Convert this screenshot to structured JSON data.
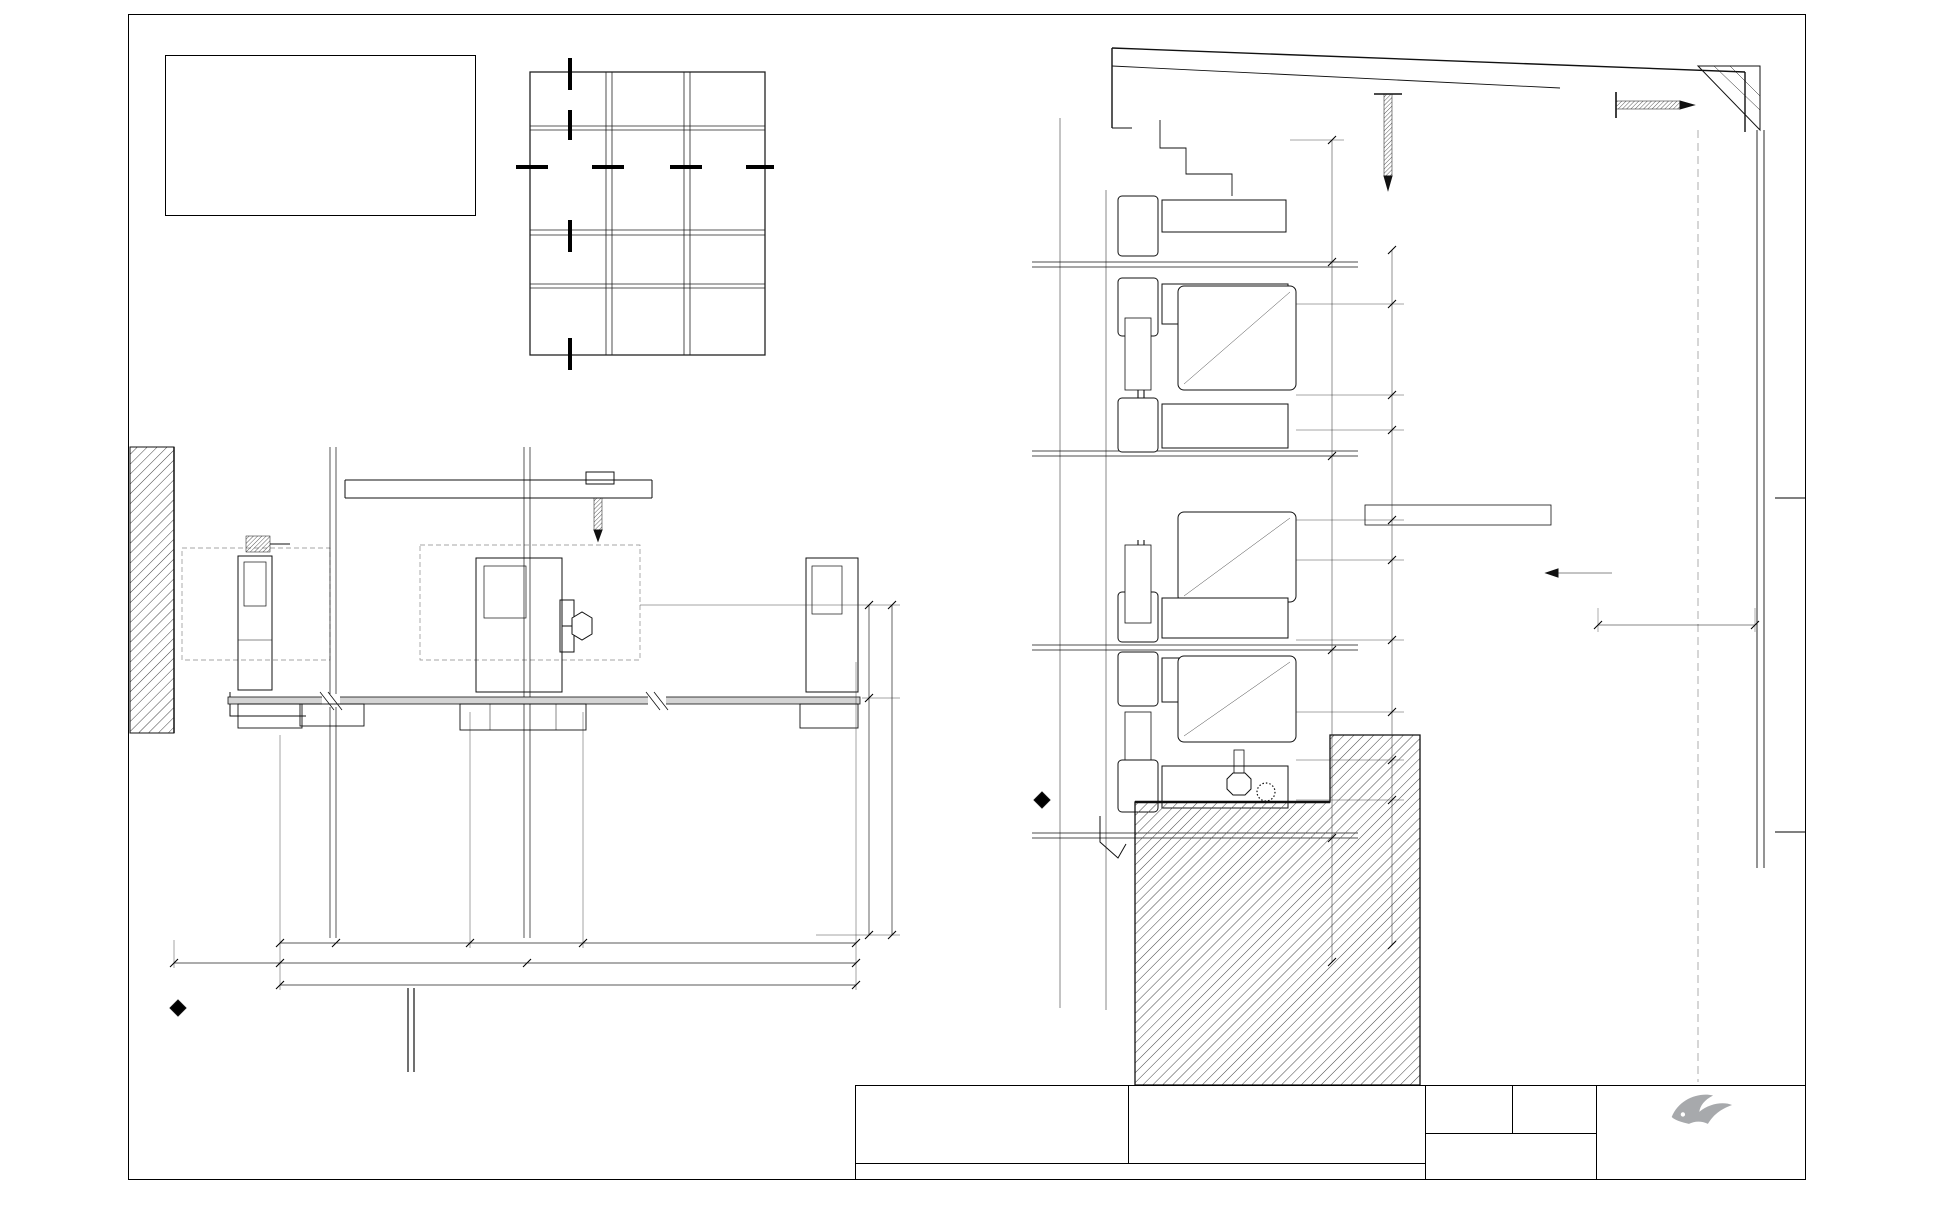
{
  "notes": {
    "title": "NOTES:",
    "lines": [
      "1] DRAWING TO BE USED IN CONJUNCTION WITH 'MASTERSPEC' (4211)",
      "2] WINDOW SYSTEMS REQUIRE SPECIFIC DESIGN DEPENDING ON SPANS,",
      "WIND-LOADS, BUILDING CONDITIONS, ETC.",
      "3] INSIDE GLAZE, INTERNAL REINFORCEMENT AND SEISMIC FRAME",
      "OPTIONS AVAILABLE"
    ],
    "specs": [
      {
        "label": "GLAZING:",
        "value": "GLASS THICKNESS TO SUIT REQUIREMENTS"
      },
      {
        "label": "HARDWARE:",
        "value": "STANDARD HARDWARE OPTIONS"
      },
      {
        "label": "FINISHES:",
        "value": "POWDER-COAT / ANODISED / PVF²"
      }
    ]
  },
  "elevation_callouts": [
    {
      "top": "04",
      "bottom": "01",
      "x": 570,
      "y": 44
    },
    {
      "top": "05",
      "bottom": "01",
      "x": 504,
      "y": 168
    },
    {
      "top": "02",
      "bottom": "01",
      "x": 572,
      "y": 151
    },
    {
      "top": "03",
      "bottom": "01",
      "x": 572,
      "y": 182
    },
    {
      "top": "06",
      "bottom": "01",
      "x": 640,
      "y": 167
    },
    {
      "top": "06",
      "bottom": "01",
      "x": 714,
      "y": 167
    },
    {
      "top": "02",
      "bottom": "01",
      "x": 572,
      "y": 289
    },
    {
      "top": "01",
      "bottom": "01",
      "x": 572,
      "y": 318
    }
  ],
  "detail_callouts": [
    {
      "num": "05",
      "sheet": "01",
      "lines": [
        "JAMB",
        "MULLION"
      ],
      "scale": "1 : 2",
      "x": 280,
      "y": 1032,
      "rx": 418
    },
    {
      "num": "06",
      "sheet": "01",
      "lines": [
        "MULLION"
      ],
      "scale": "1 : 2",
      "x": 550,
      "y": 1032,
      "rx": 645
    },
    {
      "num": "04",
      "sheet": "01",
      "lines": [
        "PARAPET",
        "CAPPING"
      ],
      "scale": "1 : 2",
      "x": 1218,
      "y": 241,
      "rx": 1336
    },
    {
      "num": "03",
      "sheet": "01",
      "lines": [
        "SPLIT TRANSOM"
      ],
      "scale": "1 : 2",
      "x": 1212,
      "y": 460,
      "rx": 1350
    },
    {
      "num": "02",
      "sheet": "01",
      "lines": [
        "TRANSOM"
      ],
      "scale": "1 : 2",
      "x": 1212,
      "y": 712,
      "rx": 1332
    },
    {
      "num": "01",
      "sheet": "01",
      "lines": [
        "SILL TRAY"
      ],
      "scale": "1 : 2",
      "x": 1212,
      "y": 882,
      "rx": 1344
    }
  ],
  "dim_labels": [
    {
      "t": "35",
      "x": 308,
      "y": 936
    },
    {
      "t": "DAYLIGHT",
      "x": 404,
      "y": 936
    },
    {
      "t": "66",
      "x": 531,
      "y": 936
    },
    {
      "t": "DAYLIGHT",
      "x": 722,
      "y": 936
    },
    {
      "t": "33",
      "x": 252,
      "y": 956
    },
    {
      "t": "MULLION SETOUT",
      "x": 410,
      "y": 956
    },
    {
      "t": "MULLION SETOUT",
      "x": 690,
      "y": 956
    },
    {
      "t": "O/A OPENING",
      "x": 566,
      "y": 978
    },
    {
      "t": "50 NOM",
      "x": 862,
      "y": 650,
      "r": -90
    },
    {
      "t": "100 MULLION",
      "x": 862,
      "y": 815,
      "r": -90
    },
    {
      "t": "150 CURTAINWALL ZONE",
      "x": 888,
      "y": 770,
      "r": -90
    },
    {
      "t": "45",
      "x": 1366,
      "y": 200,
      "r": -90
    },
    {
      "t": "86",
      "x": 1328,
      "y": 240,
      "r": -90
    },
    {
      "t": "30",
      "x": 1390,
      "y": 277,
      "r": -90
    },
    {
      "t": "40",
      "x": 1356,
      "y": 290,
      "r": -90
    },
    {
      "t": "DAYLIGHT",
      "x": 1394,
      "y": 344,
      "r": -90
    },
    {
      "t": "O/A MULLION",
      "x": 1334,
      "y": 393,
      "r": -90
    },
    {
      "t": "45",
      "x": 1390,
      "y": 394,
      "r": -90
    },
    {
      "t": "25",
      "x": 1332,
      "y": 463,
      "r": -90
    },
    {
      "t": "30",
      "x": 1390,
      "y": 520,
      "r": -90
    },
    {
      "t": "DAYLIGHT",
      "x": 1352,
      "y": 583,
      "r": -90
    },
    {
      "t": "O/A OPENING",
      "x": 1314,
      "y": 703,
      "r": -90
    },
    {
      "t": "O/A MULLION",
      "x": 1334,
      "y": 703,
      "r": -90
    },
    {
      "t": "66",
      "x": 1356,
      "y": 713,
      "r": -90
    },
    {
      "t": "DAYLIGHT",
      "x": 1356,
      "y": 797,
      "r": -90
    },
    {
      "t": "45",
      "x": 1360,
      "y": 870,
      "r": -90
    },
    {
      "t": "40",
      "x": 1336,
      "y": 948,
      "r": -90
    },
    {
      "t": "50",
      "x": 1676,
      "y": 617
    }
  ],
  "annotations": {
    "backpan_line1": "OPTIONAL BACKPAN WITH INSULATION",
    "backpan_line2": "OPTIONAL FIRE/SMOKE SEALS"
  },
  "brand_label": {
    "name": "Thermosash",
    "product": "PW40",
    "color": "#1668b5",
    "bird_color": "#a7a9ac"
  },
  "brand_positions": [
    {
      "x": 445,
      "y": 556
    },
    {
      "x": 234,
      "y": 676
    },
    {
      "x": 546,
      "y": 688
    },
    {
      "x": 1214,
      "y": 212
    },
    {
      "x": 1243,
      "y": 293
    },
    {
      "x": 1222,
      "y": 521
    },
    {
      "x": 1246,
      "y": 664
    }
  ],
  "title_block": {
    "system_label": "SYSTEM :",
    "system_name": "PW40",
    "system_desc": "UNITISED LOWRISE PANEL SYSTEMS",
    "type_label": "TYPE :",
    "type_line1": "100mm MULLION",
    "type_line2": "SINGLE GLAZED",
    "scale_label": "SCALE:",
    "scale_value": "1:2 @ A3",
    "date_label": "DATE:",
    "date_value": "Dec-12",
    "page_label": "PAGE:",
    "page_value": "PW40-01",
    "footer": "www.thermosash.co.nz ~ AUCKLAND: (09)444-4944 ~ WELLINGTON: (04)939-4500 ~ CHRISTCHURCH: (03)348-4004"
  },
  "logo": {
    "wordmark": "Thermosash",
    "tagline": "BUILDING ENVELOPE SOLUTIONS™",
    "color": "#1b4a73",
    "bird_color": "#a7a9ac"
  },
  "file_path": "P:\\CONTRACTS\\700 SERIES\\739.00-MANUALS\\For Website\\Unitised Low Rise Panel Systems - PW40\\PW40 - 100mm MULLION SINGLE GLAZED-2.dwg"
}
